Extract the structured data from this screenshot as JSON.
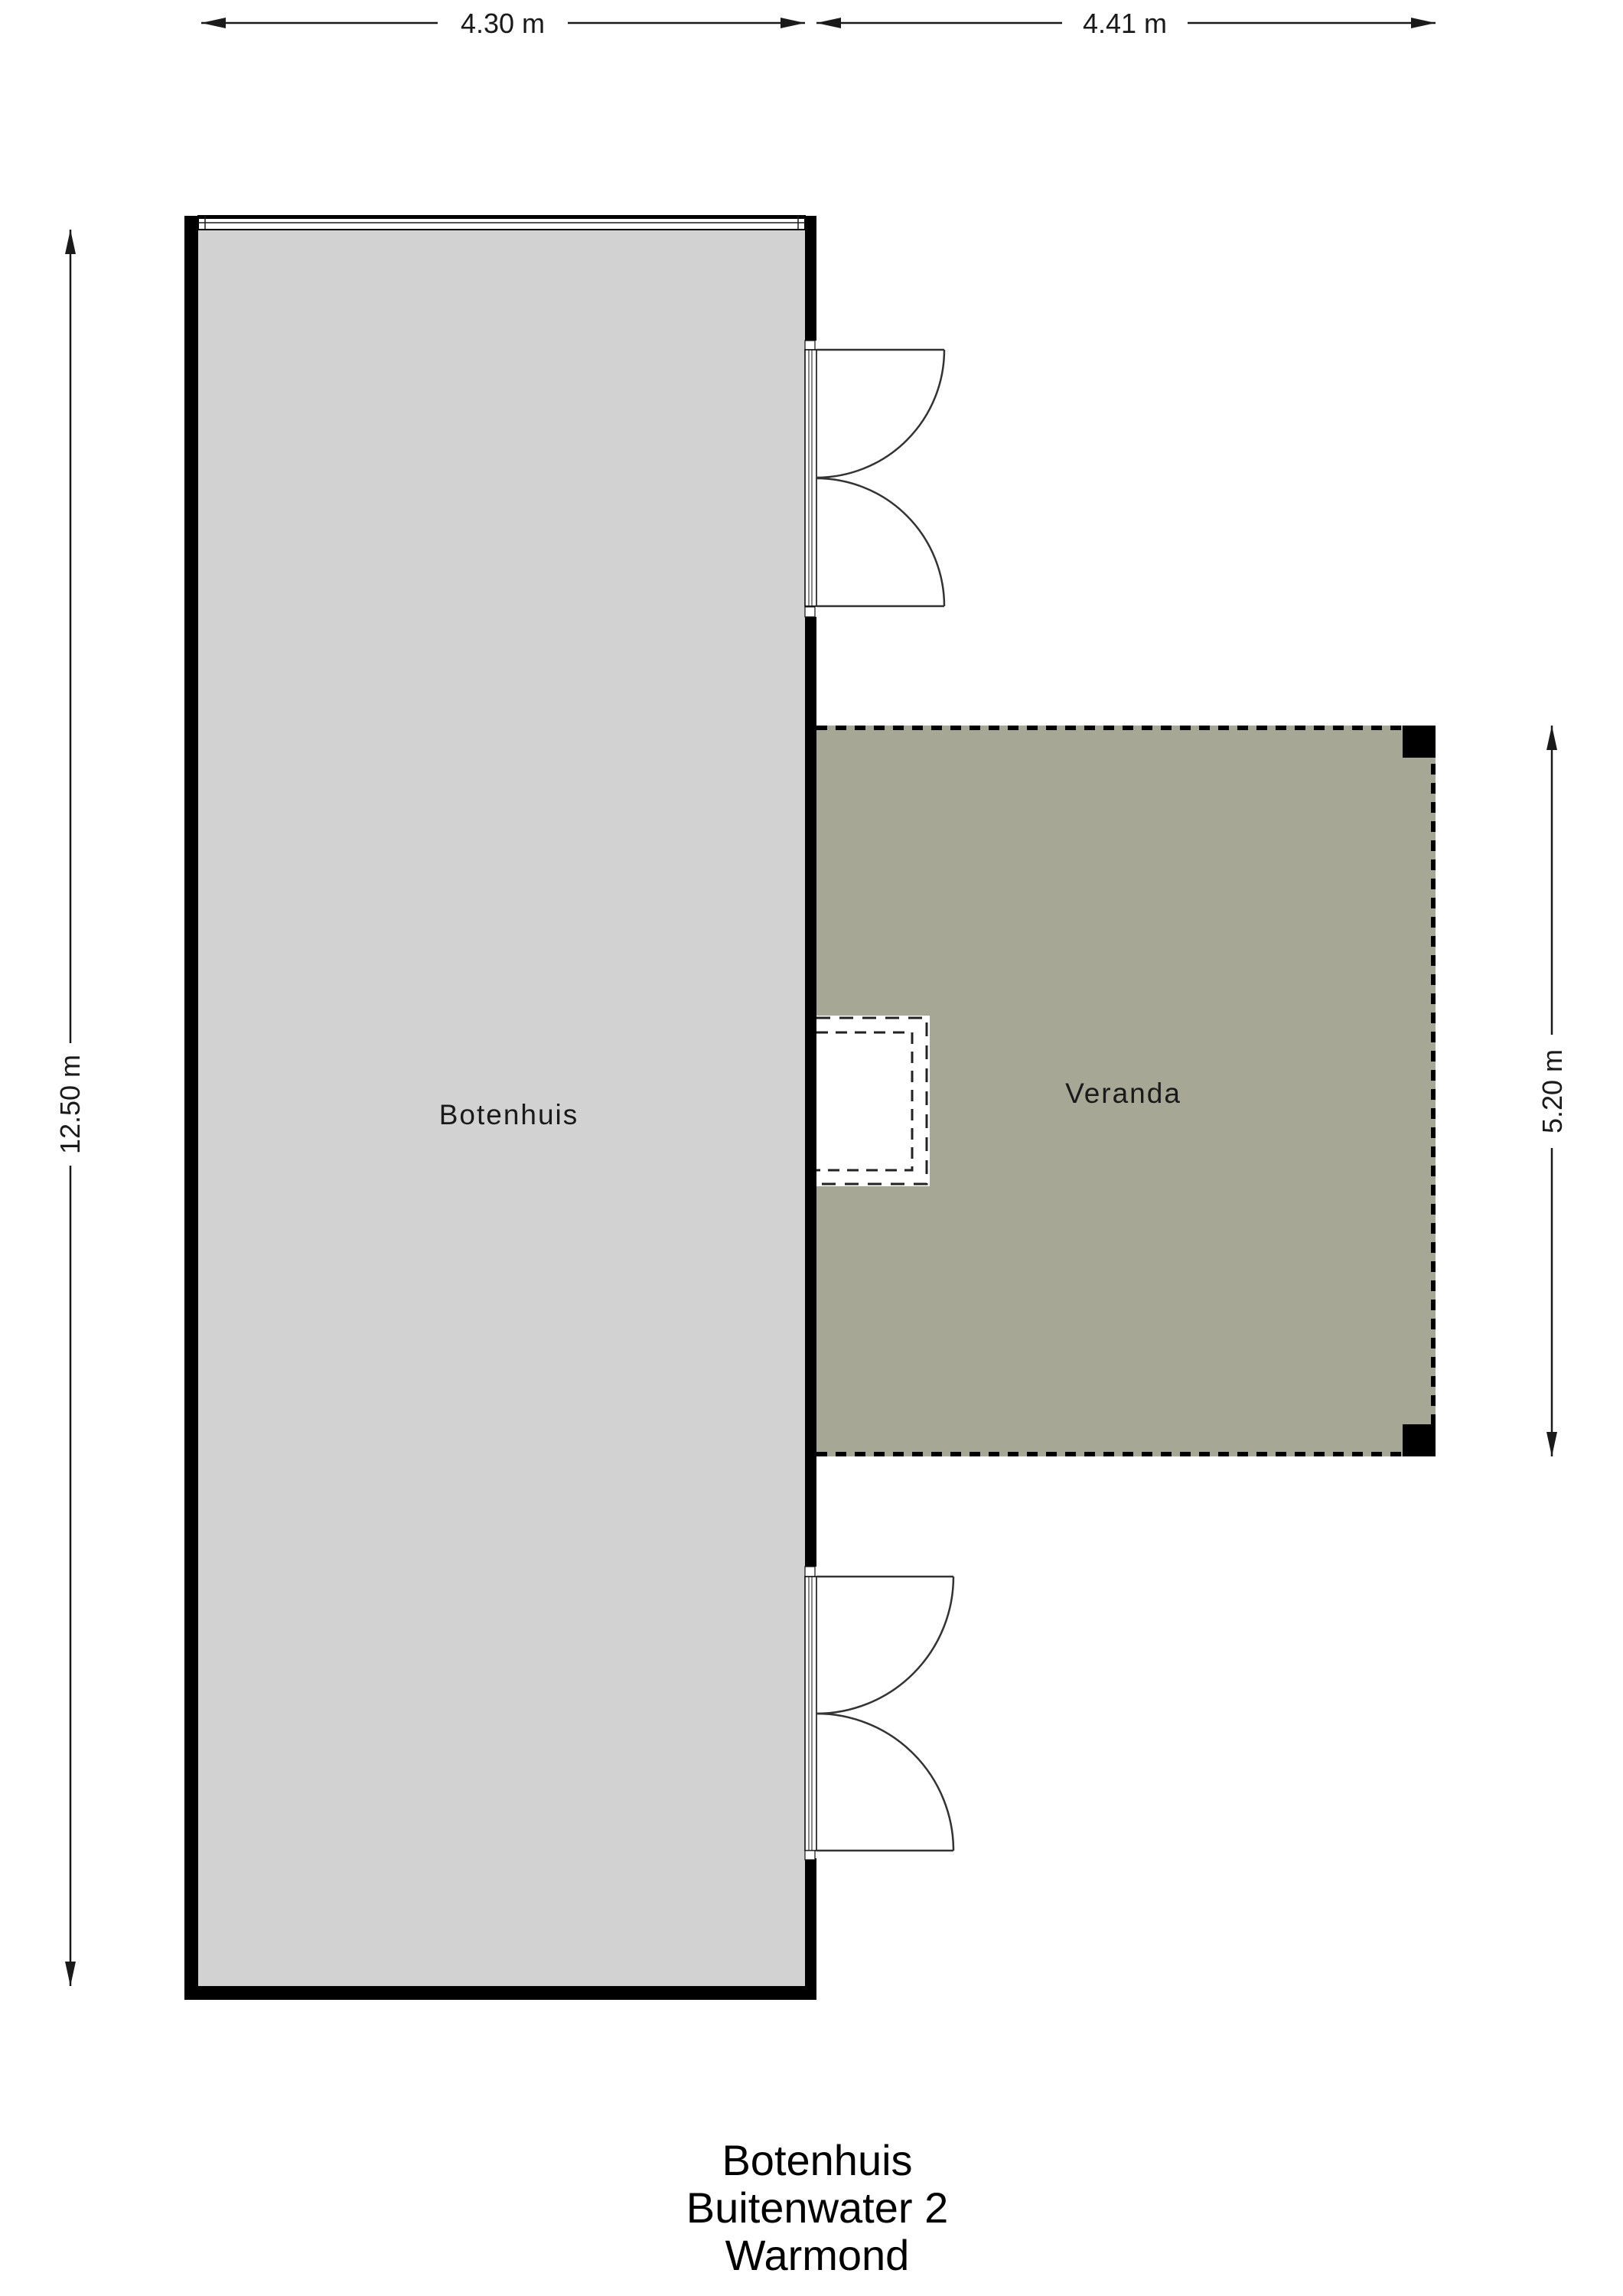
{
  "plan": {
    "kind": "floor plan",
    "rooms": {
      "botenhuis": {
        "label": "Botenhuis"
      },
      "veranda": {
        "label": "Veranda"
      }
    },
    "dimensions": {
      "botenhuis_width": {
        "label": "4.30 m",
        "value_m": 4.3
      },
      "veranda_width": {
        "label": "4.41 m",
        "value_m": 4.41
      },
      "botenhuis_height": {
        "label": "12.50 m",
        "value_m": 12.5
      },
      "veranda_height": {
        "label": "5.20 m",
        "value_m": 5.2
      }
    },
    "title": {
      "line1": "Botenhuis",
      "line2": "Buitenwater 2",
      "line3": "Warmond"
    },
    "colors": {
      "background": "#ffffff",
      "botenhuis_fill": "#d2d2d2",
      "veranda_fill": "#a7a796",
      "wall": "#000000"
    }
  }
}
